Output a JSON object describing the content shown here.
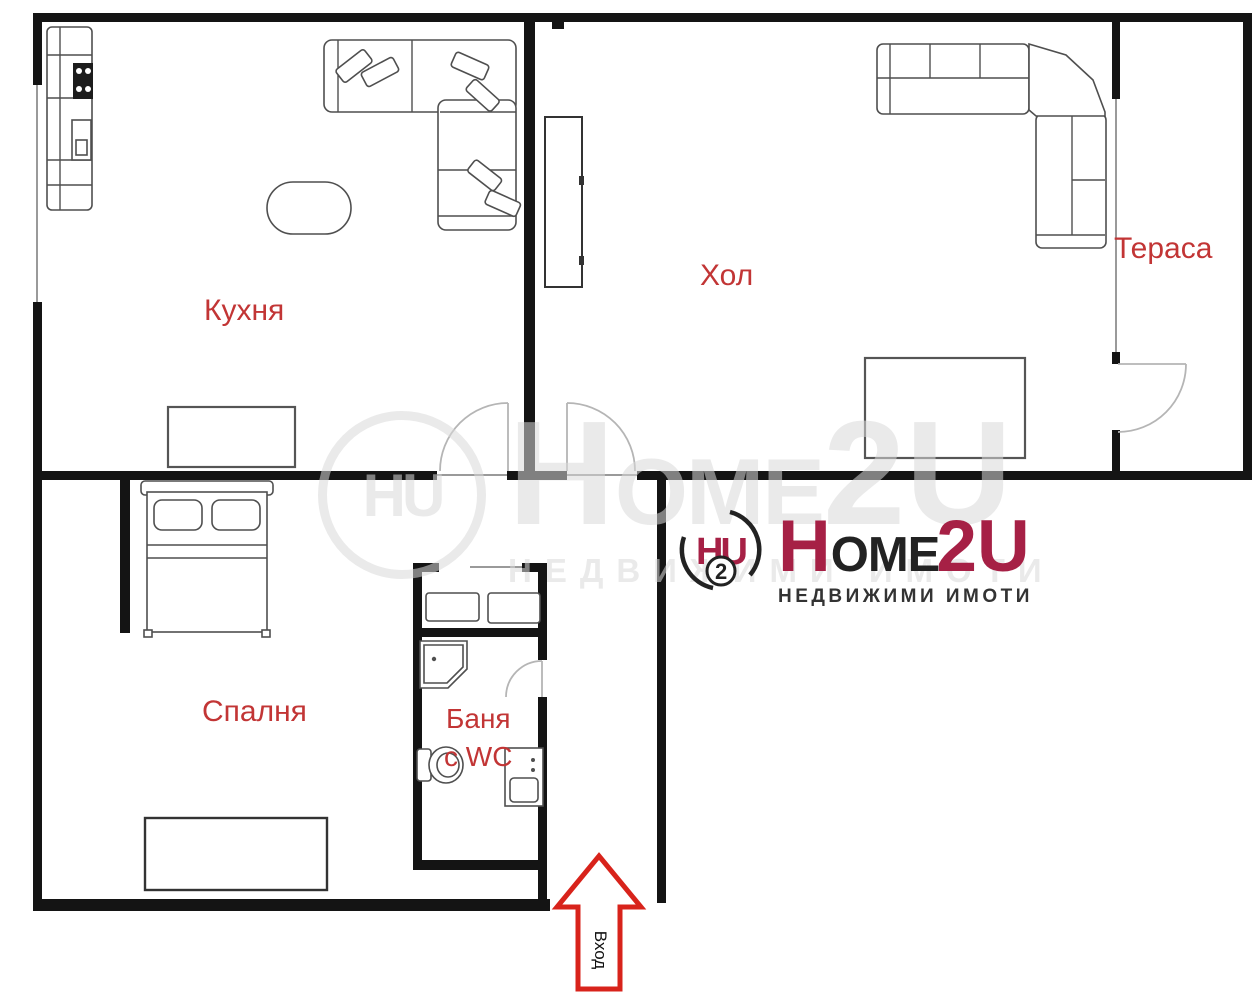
{
  "title": "Apartment floor plan",
  "rooms": {
    "kitchen": "Кухня",
    "hall": "Хол",
    "terrace": "Тераса",
    "bedroom": "Спалня",
    "bathroom_line1": "Баня",
    "bathroom_line2": "с WC"
  },
  "entrance": {
    "label": "Вход"
  },
  "logo": {
    "mark_letters": "HU",
    "mark_number": "2",
    "word_h": "H",
    "word_ome": "OME",
    "word_2u": "2U",
    "subtitle": "НЕДВИЖИМИ ИМОТИ"
  },
  "colors": {
    "wall_black": "#141414",
    "label_red": "#c23535",
    "arrow_red": "#d8231b",
    "logo_crimson": "#a62045",
    "logo_dark": "#222222",
    "watermark_gray": "#d9d9d9"
  }
}
